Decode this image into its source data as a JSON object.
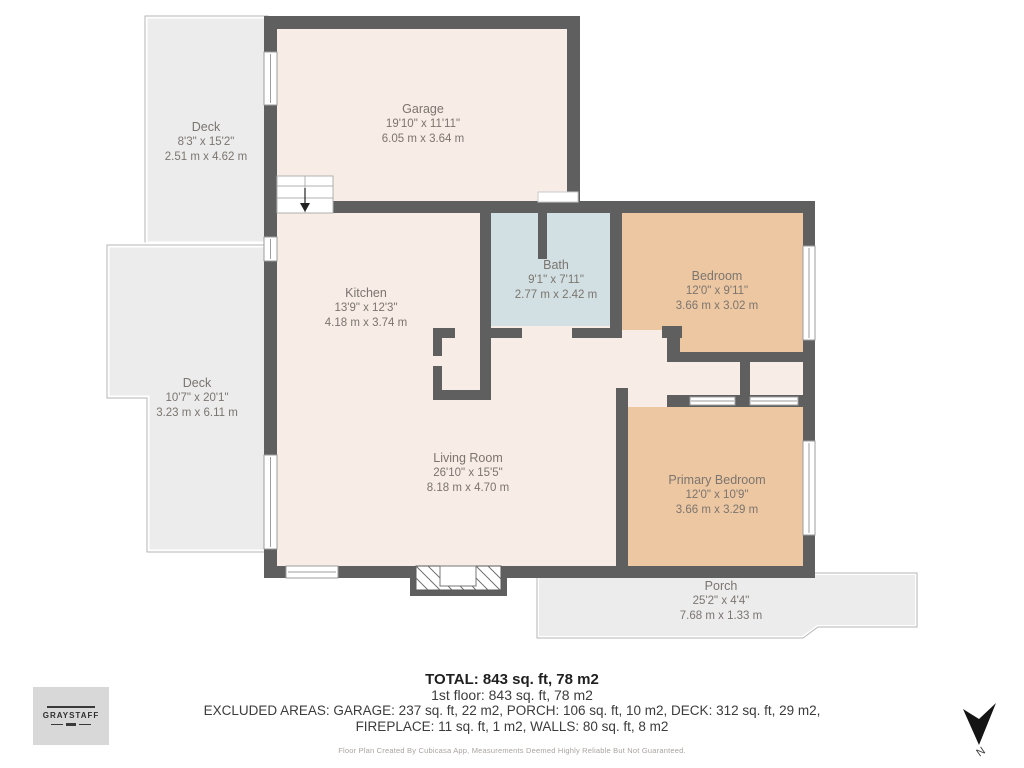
{
  "plan": {
    "rooms": [
      {
        "id": "deck_top",
        "name": "Deck",
        "imperial": "8'3\" x 15'2\"",
        "metric": "2.51 m x 4.62 m"
      },
      {
        "id": "garage",
        "name": "Garage",
        "imperial": "19'10\" x 11'11\"",
        "metric": "6.05 m x 3.64 m"
      },
      {
        "id": "kitchen",
        "name": "Kitchen",
        "imperial": "13'9\" x 12'3\"",
        "metric": "4.18 m x 3.74 m"
      },
      {
        "id": "bath",
        "name": "Bath",
        "imperial": "9'1\" x 7'11\"",
        "metric": "2.77 m x 2.42 m"
      },
      {
        "id": "bedroom",
        "name": "Bedroom",
        "imperial": "12'0\" x 9'11\"",
        "metric": "3.66 m x 3.02 m"
      },
      {
        "id": "deck_left",
        "name": "Deck",
        "imperial": "10'7\" x 20'1\"",
        "metric": "3.23 m x 6.11 m"
      },
      {
        "id": "living",
        "name": "Living Room",
        "imperial": "26'10\" x 15'5\"",
        "metric": "8.18 m x 4.70 m"
      },
      {
        "id": "primary",
        "name": "Primary Bedroom",
        "imperial": "12'0\" x 10'9\"",
        "metric": "3.66 m x 3.29 m"
      },
      {
        "id": "porch",
        "name": "Porch",
        "imperial": "25'2\" x 4'4\"",
        "metric": "7.68 m x 1.33 m"
      }
    ],
    "north_label": "N"
  },
  "summary": {
    "total": "TOTAL: 843 sq. ft, 78 m2",
    "first_floor": "1st floor: 843 sq. ft, 78 m2",
    "excluded_line1": "EXCLUDED AREAS: GARAGE: 237 sq. ft, 22 m2, PORCH: 106 sq. ft, 10 m2, DECK: 312 sq. ft, 29 m2,",
    "excluded_line2": "FIREPLACE: 11 sq. ft, 1 m2, WALLS: 80 sq. ft, 8 m2",
    "disclaimer": "Floor Plan Created By Cubicasa App, Measurements Deemed Highly Reliable But Not Guaranteed."
  },
  "branding": {
    "logo_text": "GRAYSTAFF"
  },
  "colors": {
    "wall": "#5f5f5f",
    "room_cream": "#f8ece6",
    "bath_blue": "#d2e0e3",
    "bedroom_tan": "#edc7a2",
    "deck_gray": "#ececec",
    "label_text": "#7b756f"
  }
}
